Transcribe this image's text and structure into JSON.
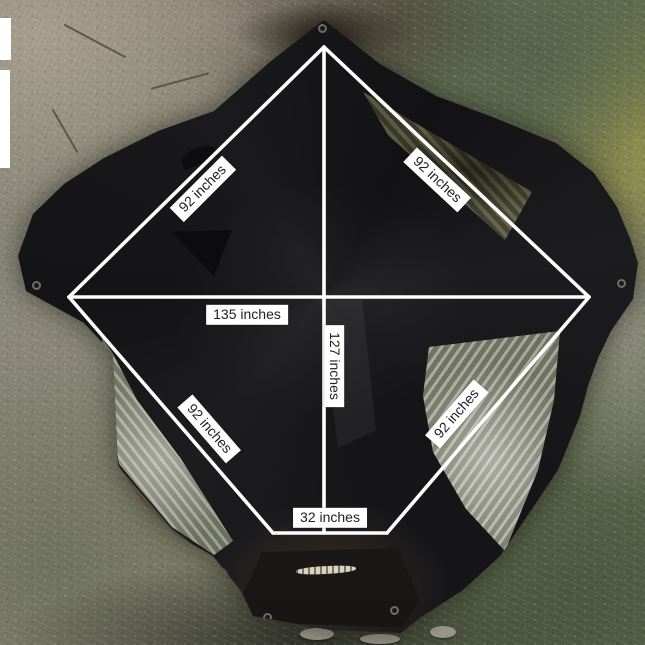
{
  "measurement_labels": {
    "upper_left_edge": "92 inches",
    "upper_right_edge": "92 inches",
    "horizontal_width": "135 inches",
    "vertical_depth": "127 inches",
    "lower_left_edge": "92 inches",
    "lower_right_edge": "92 inches",
    "bottom_width": "32 inches"
  },
  "measurement_values_inches": {
    "edge": 92,
    "width": 135,
    "depth": 127,
    "bottom": 32,
    "unit": "inches"
  },
  "colors": {
    "measurement_line": "#ffffff",
    "label_background": "#ffffff",
    "label_text": "#222222",
    "tent_fabric": "#17171a",
    "ground_moss_green": "#5d6749",
    "ground_sand_grey": "#8a8577"
  }
}
